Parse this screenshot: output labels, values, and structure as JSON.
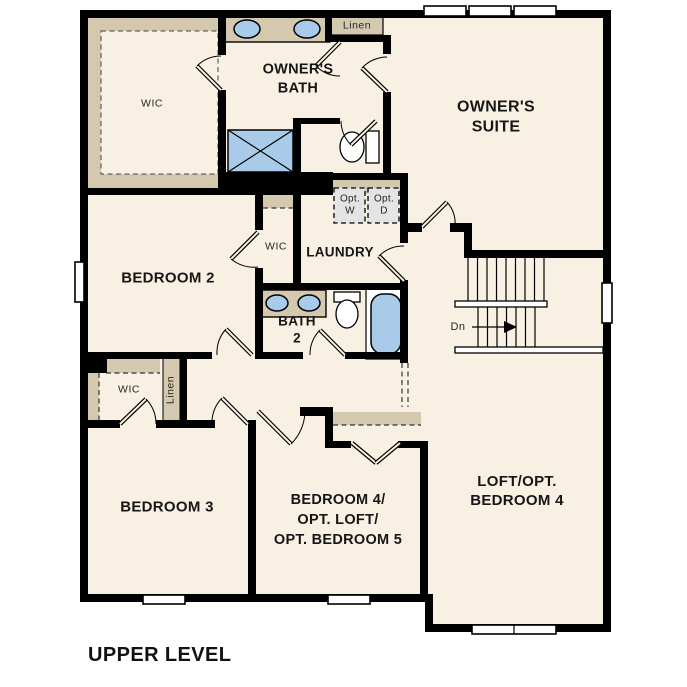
{
  "title": "UPPER LEVEL",
  "colors": {
    "floor": "#f8f0e3",
    "wall": "#000000",
    "counter": "#d4c8af",
    "fixture_blue": "#a9cbe9",
    "optional_fill": "#e4e4e4"
  },
  "labels": {
    "wic_owners": "WIC",
    "owners_bath": "OWNER'S\nBATH",
    "linen_top": "Linen",
    "owners_suite": "OWNER'S\nSUITE",
    "opt_washer": "Opt.\nW",
    "opt_dryer": "Opt.\nD",
    "laundry": "LAUNDRY",
    "wic_hall": "WIC",
    "bedroom_2": "BEDROOM 2",
    "bath_2": "BATH\n2",
    "stairs_down": "Dn",
    "wic_bedroom_3": "WIC",
    "linen_hall": "Linen",
    "bedroom_3": "BEDROOM 3",
    "bedroom_4_5": "BEDROOM 4/\nOPT. LOFT/\nOPT. BEDROOM 5",
    "loft": "LOFT/OPT.\nBEDROOM 4"
  }
}
